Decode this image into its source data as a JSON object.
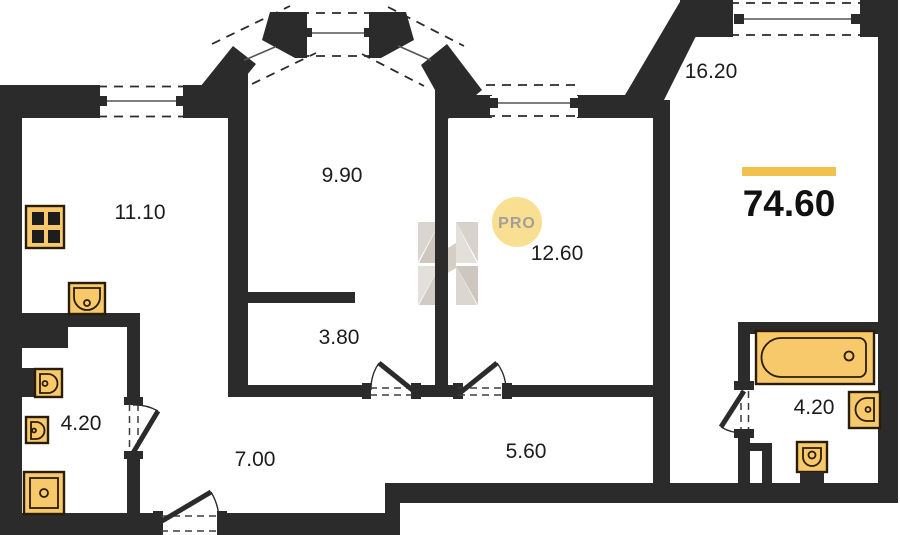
{
  "plan": {
    "rooms": [
      {
        "id": "kitchen",
        "area": "11.10"
      },
      {
        "id": "bay-room",
        "area": "9.90"
      },
      {
        "id": "living-room",
        "area": "16.20"
      },
      {
        "id": "bedroom",
        "area": "12.60"
      },
      {
        "id": "wardrobe",
        "area": "3.80"
      },
      {
        "id": "bathroom-left",
        "area": "4.20"
      },
      {
        "id": "hallway",
        "area": "7.00"
      },
      {
        "id": "corridor",
        "area": "5.60"
      },
      {
        "id": "bathroom-right",
        "area": "4.20"
      }
    ],
    "total_area": {
      "value": "74.60",
      "accent_color": "#f2c14d"
    },
    "watermark": {
      "pro_label": "PRO",
      "circle_color": "#f8df92"
    },
    "colors": {
      "wall": "#2b2b2b",
      "fixture": "#f8c96a"
    }
  }
}
